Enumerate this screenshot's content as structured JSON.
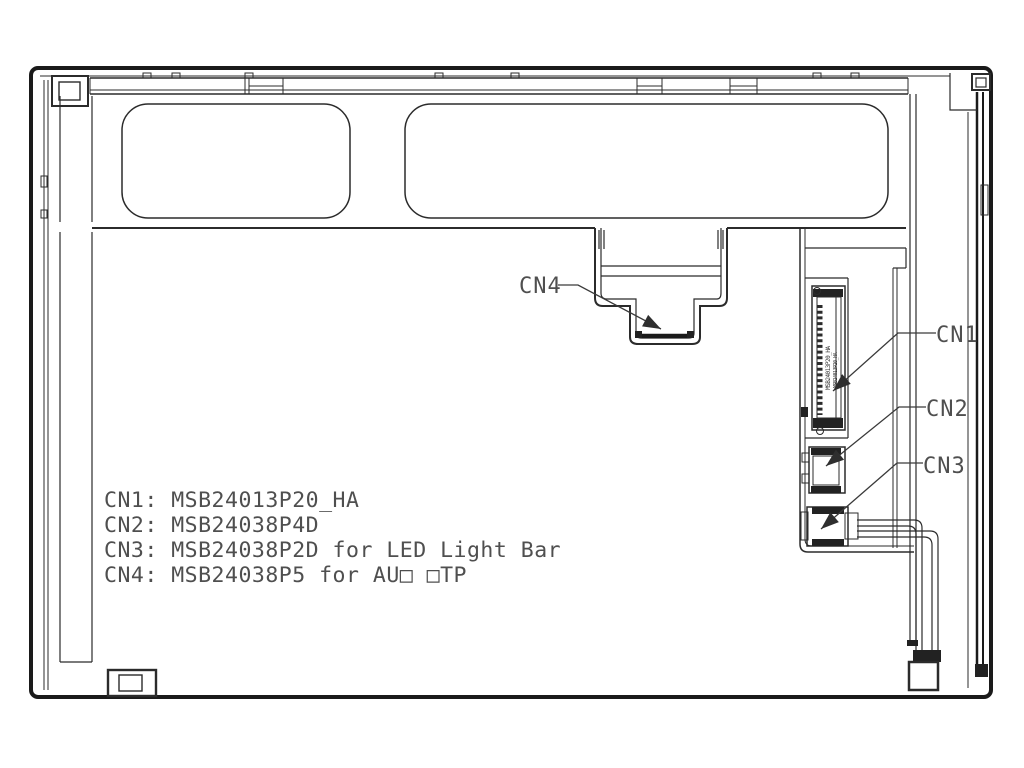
{
  "diagram": {
    "kind": "lcd-module-rear-view-connector-drawing",
    "background_color": "#ffffff",
    "line_color": "#2b2b2b",
    "frame_color": "#1a1a1a",
    "text_color": "#4f4f4f",
    "callouts": {
      "cn1": "CN1",
      "cn2": "CN2",
      "cn3": "CN3",
      "cn4": "CN4"
    },
    "legend": [
      "CN1: MSB24013P20_HA",
      "CN2: MSB24038P4D",
      "CN3: MSB24038P2D for LED Light Bar",
      "CN4: MSB24038P5 for AU□ □TP"
    ],
    "cn1_marking": "MSB24013P20_HA"
  }
}
